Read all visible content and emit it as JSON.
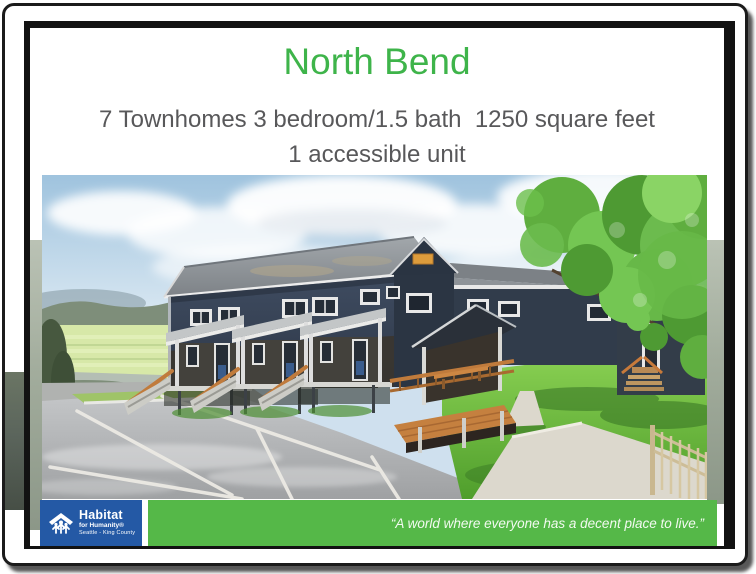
{
  "slide": {
    "title": "North Bend",
    "subtitle_line1": "7 Townhomes 3 bedroom/1.5 bath  1250 square feet",
    "subtitle_line2": "1 accessible unit"
  },
  "footer": {
    "logo_name": "Habitat",
    "logo_sub": "for Humanity®",
    "logo_region": "Seattle - King County",
    "quote": "“A world where everyone has a decent place to live.”"
  },
  "colors": {
    "title_green": "#3eb44a",
    "bar_green": "#55b848",
    "logo_blue": "#2459a5",
    "subtitle_gray": "#58585a",
    "slide_border": "#121212",
    "sky_blue": "#b8d4e8",
    "lawn_green": "#6cc53e",
    "building_navy": "#323c4a"
  }
}
